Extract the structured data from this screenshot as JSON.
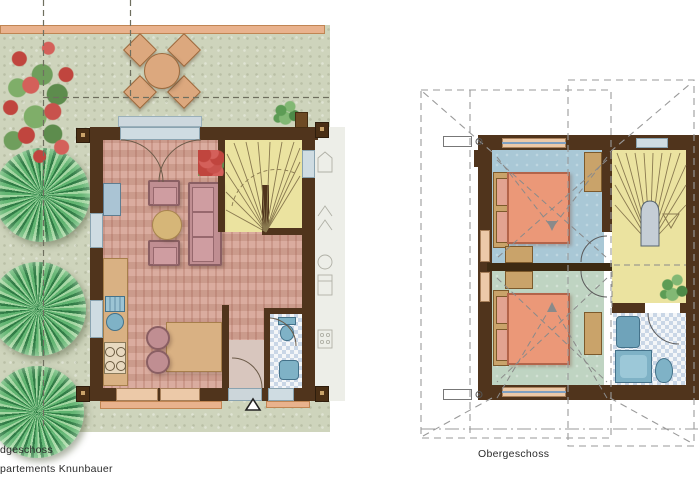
{
  "labels": {
    "floor_left": "dgeschoss",
    "project": "partements Knunbauer",
    "floor_right": "Obergeschoss"
  },
  "plans": {
    "ground_floor": {
      "label": "dgeschoss",
      "rooms": [
        "living-room",
        "kitchen-dining",
        "staircase",
        "bathroom",
        "vestibule"
      ],
      "garden_features": [
        "three-trees",
        "flowering-shrub",
        "terrace-table-with-four-chairs",
        "potted-plant"
      ],
      "markers": [
        "entrance-triangle"
      ]
    },
    "upper_floor": {
      "label": "Obergeschoss",
      "rooms": [
        "bedroom-north",
        "bedroom-south",
        "staircase-hall",
        "bathroom"
      ],
      "features": [
        "roof-outline-dashed",
        "slope-arrows",
        "potted-plant",
        "dimension-boxes"
      ]
    }
  },
  "palette": {
    "wall_brown": "#50341c",
    "garden_green": "#ced4bc",
    "terrace_peach": "#e9b28d",
    "parquet_pink": "#d6a394",
    "stair_yellow": "#ebe3a0",
    "bedroom_blue": "#a9c8d6",
    "bedroom_green": "#bfd4c2",
    "bed_salmon": "#eb9878",
    "sofa_rose": "#c08e92",
    "wood_tan": "#d9b183",
    "fixture_blue": "#7fb2c6",
    "tile_blue": "#c9d6e6",
    "tree_green": "#54b068",
    "dash_gray": "#999999"
  }
}
